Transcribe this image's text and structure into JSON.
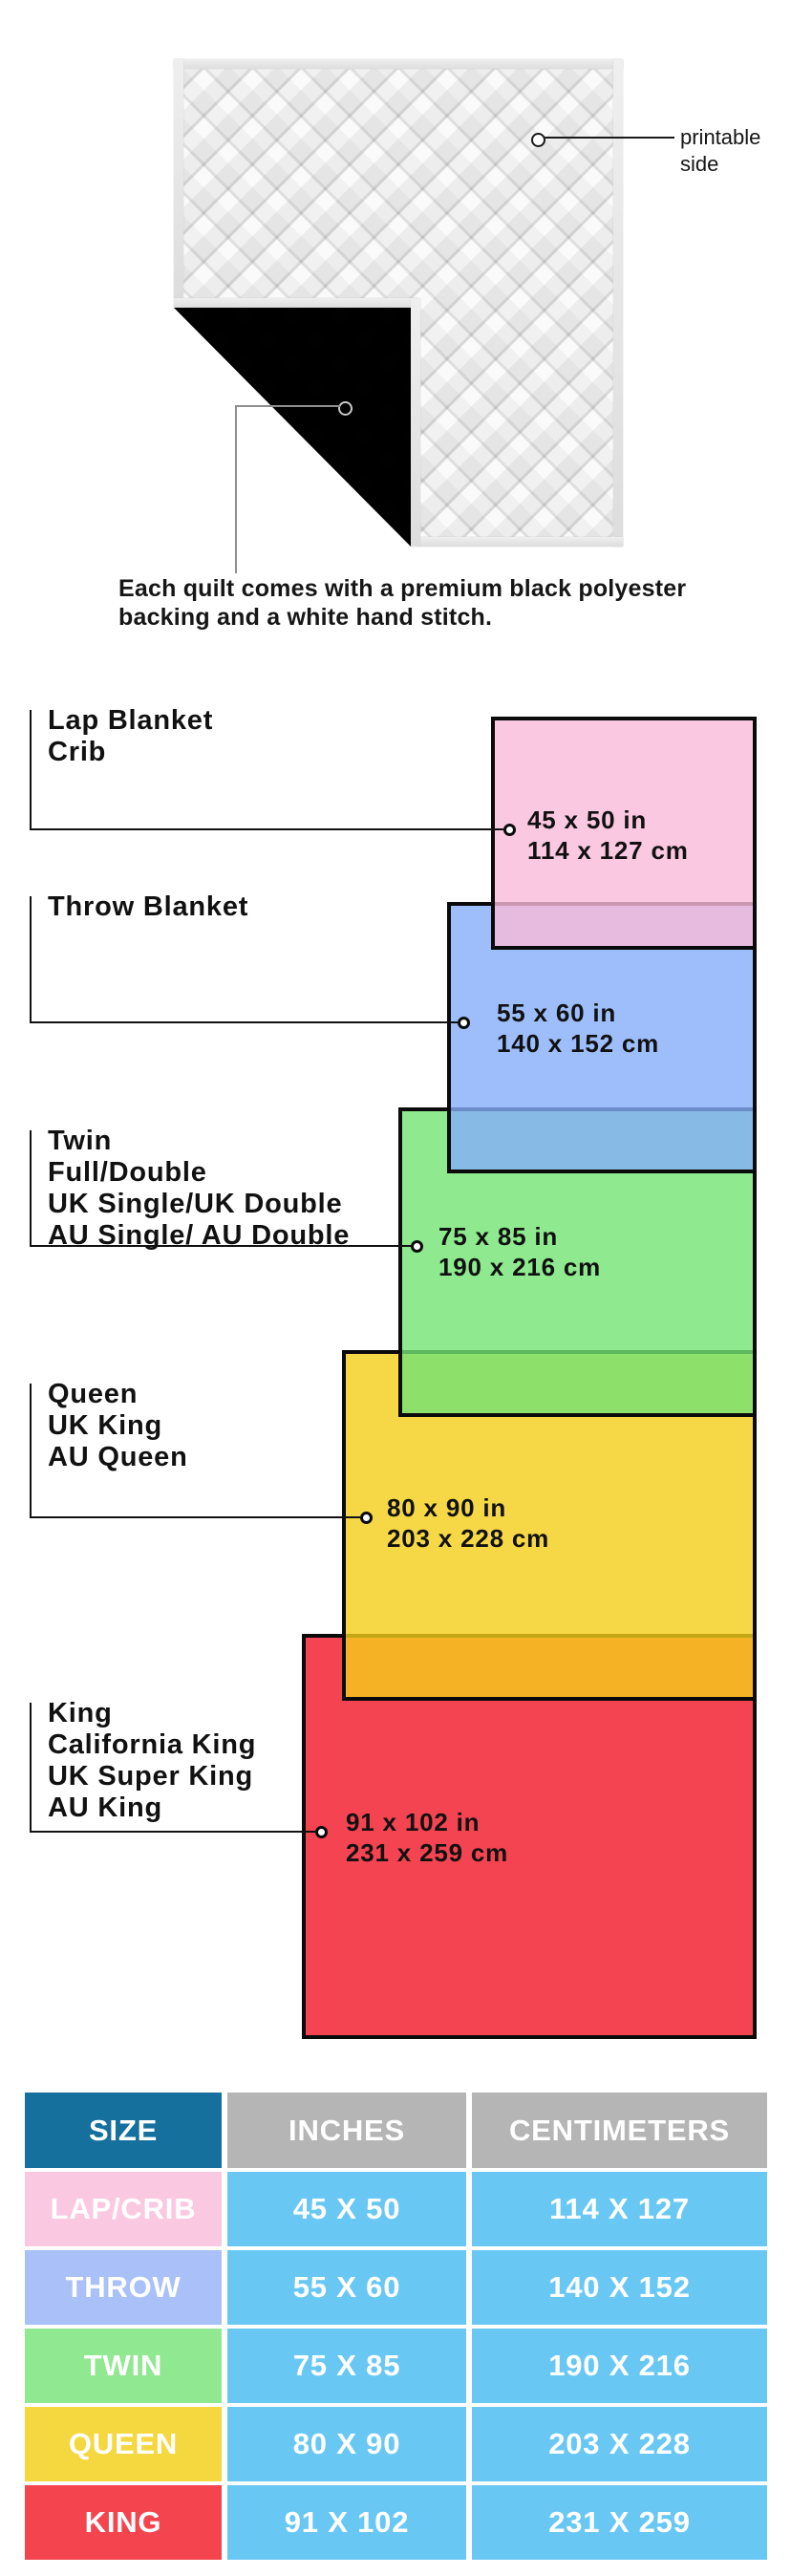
{
  "quilt": {
    "printable_label_line1": "printable",
    "printable_label_line2": "side",
    "caption_line1": "Each quilt comes with a premium black polyester",
    "caption_line2": "backing and a white hand stitch.",
    "front_color": "#fafafa",
    "back_color": "#161616",
    "binding_color": "#e4e4e4"
  },
  "diagram": {
    "sizes": [
      {
        "id": "lap",
        "labels": [
          "Lap Blanket",
          "Crib"
        ],
        "dim_in": "45 x 50 in",
        "dim_cm": "114 x 127 cm",
        "fill": "rgba(250,186,218,0.8)",
        "solid": "#fbc8e1"
      },
      {
        "id": "throw",
        "labels": [
          "Throw Blanket"
        ],
        "dim_in": "55 x 60 in",
        "dim_cm": "140 x 152 cm",
        "fill": "rgba(132,174,249,0.8)",
        "solid": "#9dbefa"
      },
      {
        "id": "twin",
        "labels": [
          "Twin",
          "Full/Double",
          "UK Single/UK Double",
          "AU Single/ AU Double"
        ],
        "dim_in": "75 x 85 in",
        "dim_cm": "190 x 216 cm",
        "fill": "rgba(115,227,115,0.8)",
        "solid": "#8fe98f"
      },
      {
        "id": "queen",
        "labels": [
          "Queen",
          "UK King",
          "AU Queen"
        ],
        "dim_in": "80 x 90 in",
        "dim_cm": "203 x 228 cm",
        "fill": "rgba(244,206,25,0.8)",
        "solid": "#f6d847"
      },
      {
        "id": "king",
        "labels": [
          "King",
          "California King",
          "UK Super King",
          "AU King"
        ],
        "dim_in": "91 x 102 in",
        "dim_cm": "231 x 259 cm",
        "fill": "rgba(241,21,39,0.8)",
        "solid": "#f44452"
      }
    ],
    "line_color": "#111111"
  },
  "table": {
    "headers": [
      "SIZE",
      "INCHES",
      "CENTIMETERS"
    ],
    "header_size_bg": "#15709e",
    "header_gray_bg": "#b5b5b5",
    "value_cell_bg": "#69c8f3",
    "text_color": "#ffffff",
    "rows": [
      {
        "size": "LAP/CRIB",
        "inches": "45 X 50",
        "cm": "114 X 127",
        "swatch": "#fbc8e1"
      },
      {
        "size": "THROW",
        "inches": "55 X 60",
        "cm": "140 X 152",
        "swatch": "#a9c0f8"
      },
      {
        "size": "TWIN",
        "inches": "75 X 85",
        "cm": "190 X 216",
        "swatch": "#90e890"
      },
      {
        "size": "QUEEN",
        "inches": "80 X 90",
        "cm": "203 X 228",
        "swatch": "#f5d83f"
      },
      {
        "size": "KING",
        "inches": "91 X 102",
        "cm": "231 X 259",
        "swatch": "#f4454f"
      }
    ]
  }
}
